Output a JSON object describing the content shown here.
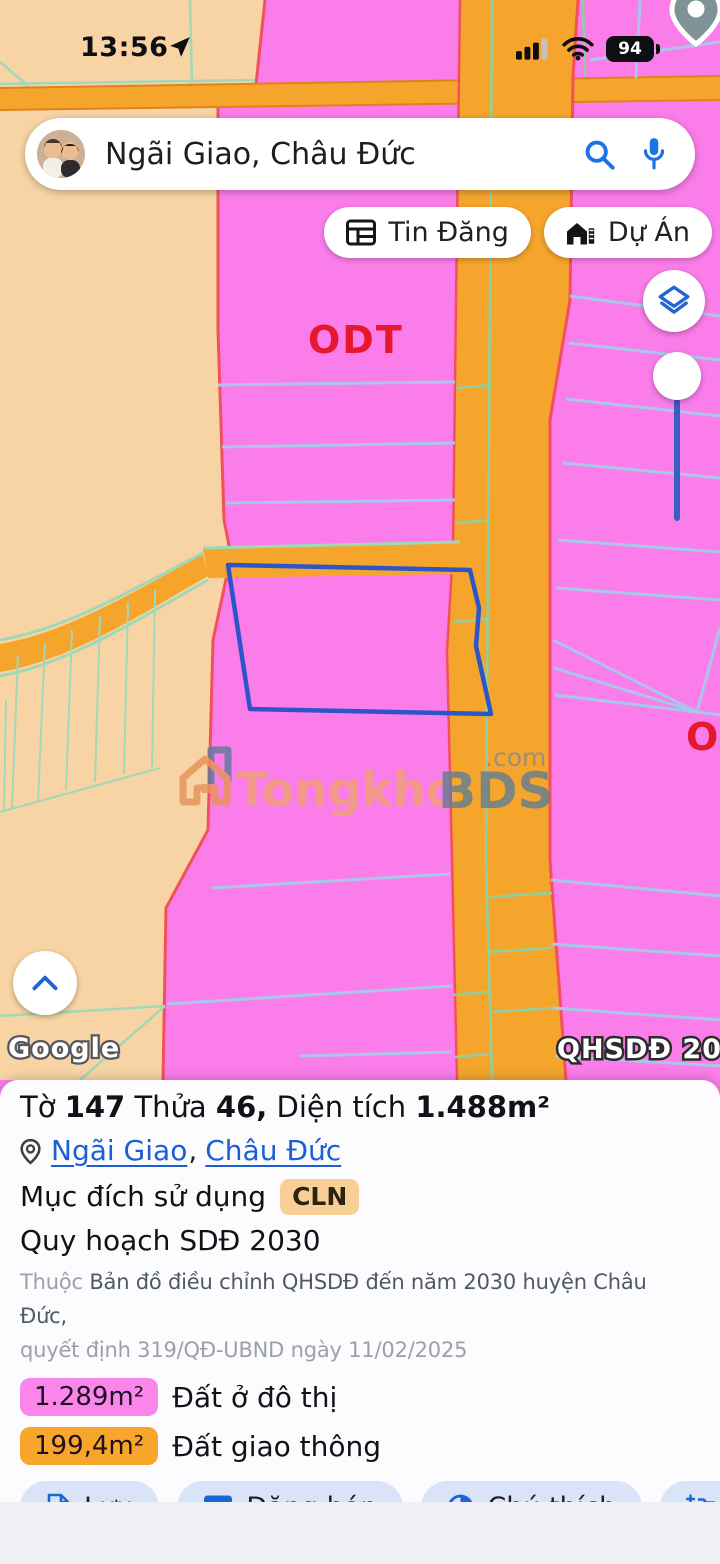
{
  "status_bar": {
    "time": "13:56",
    "battery_level": "94"
  },
  "search_bar": {
    "query": "Ngãi Giao, Châu Đức"
  },
  "map_chips": {
    "listings": "Tin Đăng",
    "projects": "Dự Án"
  },
  "map": {
    "zone_label_left": "ODT",
    "zone_label_right": "O",
    "plan_badge": "QHSDĐ 2030",
    "google_logo": "Google",
    "watermark": {
      "brand": "Tongkho",
      "brand_bold": "BDS",
      "suffix": ".com"
    }
  },
  "panel": {
    "title": {
      "p1": "Tờ",
      "n1": "147",
      "p2": "Thửa",
      "n2": "46,",
      "p3": "Diện tích",
      "n3": "1.488m²"
    },
    "location": {
      "ward": "Ngãi Giao",
      "separator": ",",
      "district": "Châu Đức"
    },
    "usage": {
      "label": "Mục đích sử dụng",
      "badge": "CLN"
    },
    "plan_row": "Quy hoạch SDĐ 2030",
    "source": {
      "prefix": "Thuộc",
      "line1": "Bản đồ điều chỉnh QHSDĐ đến năm 2030 huyện Châu Đức,",
      "line2": "quyết định 319/QĐ-UBND ngày 11/02/2025"
    },
    "legend": [
      {
        "value": "1.289m²",
        "label": "Đất ở đô thị",
        "color": "#fa86ec"
      },
      {
        "value": "199,4m²",
        "label": "Đất giao thông",
        "color": "#f8a62b"
      }
    ],
    "actions": [
      {
        "label": "Lưu",
        "icon": "note-add-icon"
      },
      {
        "label": "Đăng bán",
        "icon": "table-icon"
      },
      {
        "label": "Chú thích",
        "icon": "contrast-icon"
      },
      {
        "label": "Ch",
        "icon": "add-photo-icon"
      }
    ]
  },
  "icons": [
    "location-arrow-icon",
    "signal-icon",
    "wifi-icon",
    "battery-icon",
    "search-icon",
    "mic-icon",
    "newspaper-icon",
    "home-work-icon",
    "layers-icon",
    "chevron-up-icon",
    "map-pin-icon",
    "pin-outline-icon"
  ],
  "palette": {
    "pink_zone": "#fa7de9",
    "peach_zone": "#f8d4a4",
    "road_orange": "#f5a52c",
    "boundary_red": "#f2515c",
    "line_blue": "#a9c6ea",
    "line_green": "#9fd9b8",
    "parcel_blue": "#2c55c8",
    "label_red": "#e5182e",
    "link_blue": "#1a5fd4",
    "icon_blue": "#1a66d8",
    "badge_cln_bg": "#f8cf96",
    "badge_pink_bg": "#fa86ec",
    "badge_orange_bg": "#f8a62b",
    "action_pill_bg": "#d9e4f9"
  }
}
